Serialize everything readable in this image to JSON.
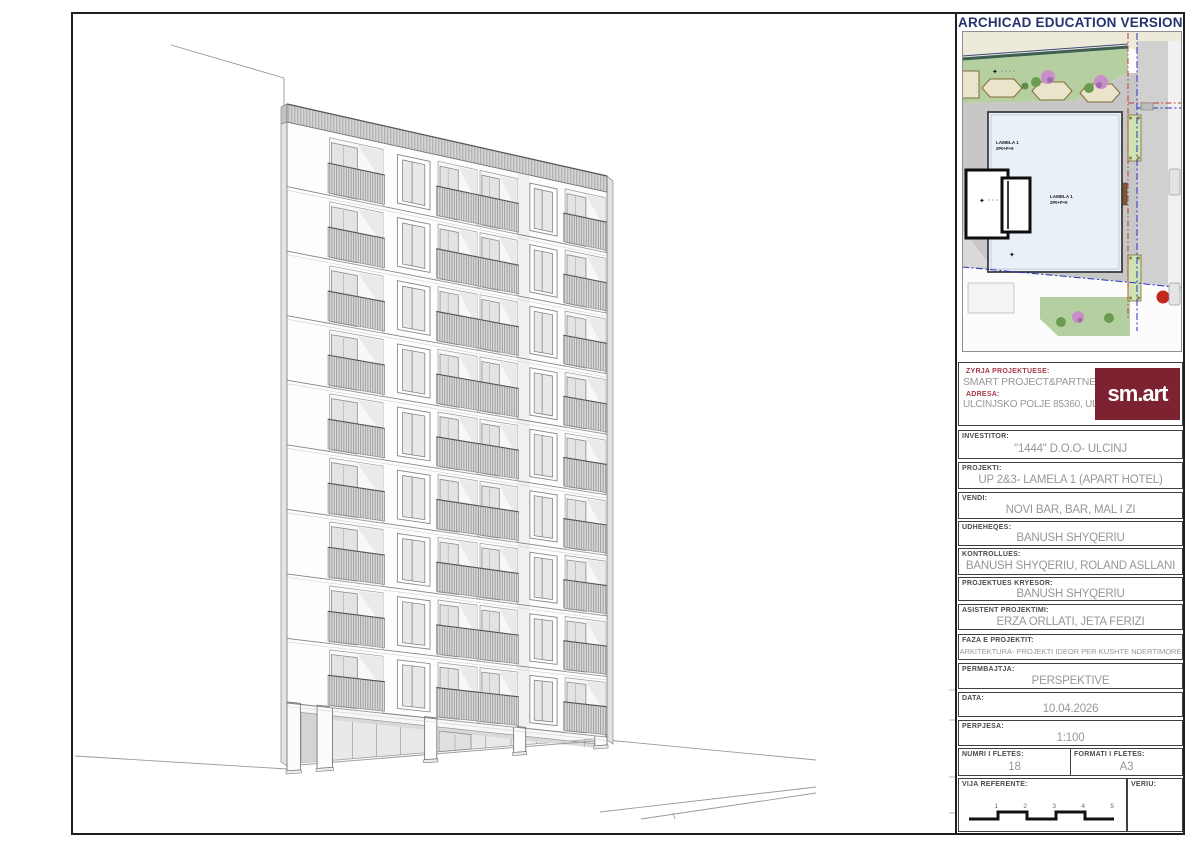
{
  "header": {
    "watermark": "ARCHICAD EDUCATION VERSION"
  },
  "title_block": {
    "office": {
      "label": "ZYRJA PROJEKTUESE:",
      "value": "SMART PROJECT&PARTNERS",
      "address_label": "ADRESA:",
      "address_value": "ULCINJSKO POLJE 85360, ULCINJ",
      "logo_text": "sm.art"
    },
    "fields": [
      {
        "label": "INVESTITOR:",
        "value": "\"1444\" D.O.O- ULCINJ"
      },
      {
        "label": "PROJEKTI:",
        "value": "UP 2&3- LAMELA 1 (APART HOTEL)"
      },
      {
        "label": "VENDI:",
        "value": "NOVI BAR, BAR, MAL I ZI"
      },
      {
        "label": "UDHEHEQES:",
        "value": "BANUSH SHYQERIU"
      },
      {
        "label": "KONTROLLUES:",
        "value": "BANUSH SHYQERIU, ROLAND ASLLANI"
      },
      {
        "label": "PROJEKTUES KRYESOR:",
        "value": "BANUSH SHYQERIU"
      },
      {
        "label": "ASISTENT PROJEKTIMI:",
        "value": "ERZA ORLLATI, JETA FERIZI"
      },
      {
        "label": "FAZA E PROJEKTIT:",
        "value": "ARKITEKTURA- PROJEKTI IDEOR PER KUSHTE NDERTIMORE",
        "small": true
      },
      {
        "label": "PERMBAJTJA:",
        "value": "PERSPEKTIVE"
      },
      {
        "label": "DATA:",
        "value": "10.04.2026"
      },
      {
        "label": "PERPJESA:",
        "value": "1:100"
      }
    ],
    "sheet_number": {
      "label": "NUMRI I FLETES:",
      "value": "18"
    },
    "sheet_format": {
      "label": "FORMATI I FLETES:",
      "value": "A3"
    },
    "reference_line": {
      "label": "VIJA REFERENTE:",
      "ticks": [
        "1",
        "2",
        "3",
        "4",
        "5"
      ]
    },
    "north": {
      "label": "VERIU:"
    }
  },
  "site_plan": {
    "building_label_top": [
      "LAMELA 1",
      "2P0+P+9"
    ],
    "building_label_mid": [
      "LAMELA 1",
      "2P0+P+9"
    ]
  },
  "drawing": {
    "facade": {
      "x1": 287,
      "x2": 607,
      "y_top_left": 122,
      "y_top_right": 192,
      "y_floors_bottom_left": 703,
      "y_floors_bottom_right": 737,
      "terrain_left": 766,
      "terrain_right": 740,
      "floors": 9
    },
    "parapet": {
      "top_left": 104,
      "top_right": 176
    },
    "bays": [
      {
        "type": "balcony",
        "u1": 0.133,
        "u2": 0.3
      },
      {
        "type": "window",
        "u1": 0.345,
        "u2": 0.447
      },
      {
        "type": "balcony",
        "u1": 0.472,
        "u2": 0.594
      },
      {
        "type": "balcony",
        "u1": 0.603,
        "u2": 0.719
      },
      {
        "type": "window",
        "u1": 0.759,
        "u2": 0.844
      },
      {
        "type": "balcony",
        "u1": 0.869,
        "u2": 0.994
      }
    ],
    "shade_strip": {
      "u1": 0.719,
      "u2": 0.759
    },
    "columns": [
      [
        0,
        0.042
      ],
      [
        0.094,
        0.142
      ],
      [
        0.43,
        0.468
      ],
      [
        0.708,
        0.746
      ],
      [
        0.962,
        1.0
      ]
    ],
    "storefront": {
      "u1": 0.045,
      "u2": 0.99,
      "door_u1": 0.475,
      "door_u2": 0.575,
      "mullions": [
        0.13,
        0.205,
        0.28,
        0.355,
        0.435,
        0.62,
        0.7,
        0.78,
        0.865,
        0.93
      ]
    }
  },
  "colors": {
    "accent_maroon": "#7d2230",
    "label_maroon": "#a33b47",
    "watermark_blue": "#27336e",
    "label_gray": "#4a4a4a",
    "value_gray": "#979797",
    "footprint_fill": "#e9f0f8",
    "green": "#b6cfa1",
    "pavement": "#c7c7c7",
    "red_marker": "#c2281c"
  }
}
